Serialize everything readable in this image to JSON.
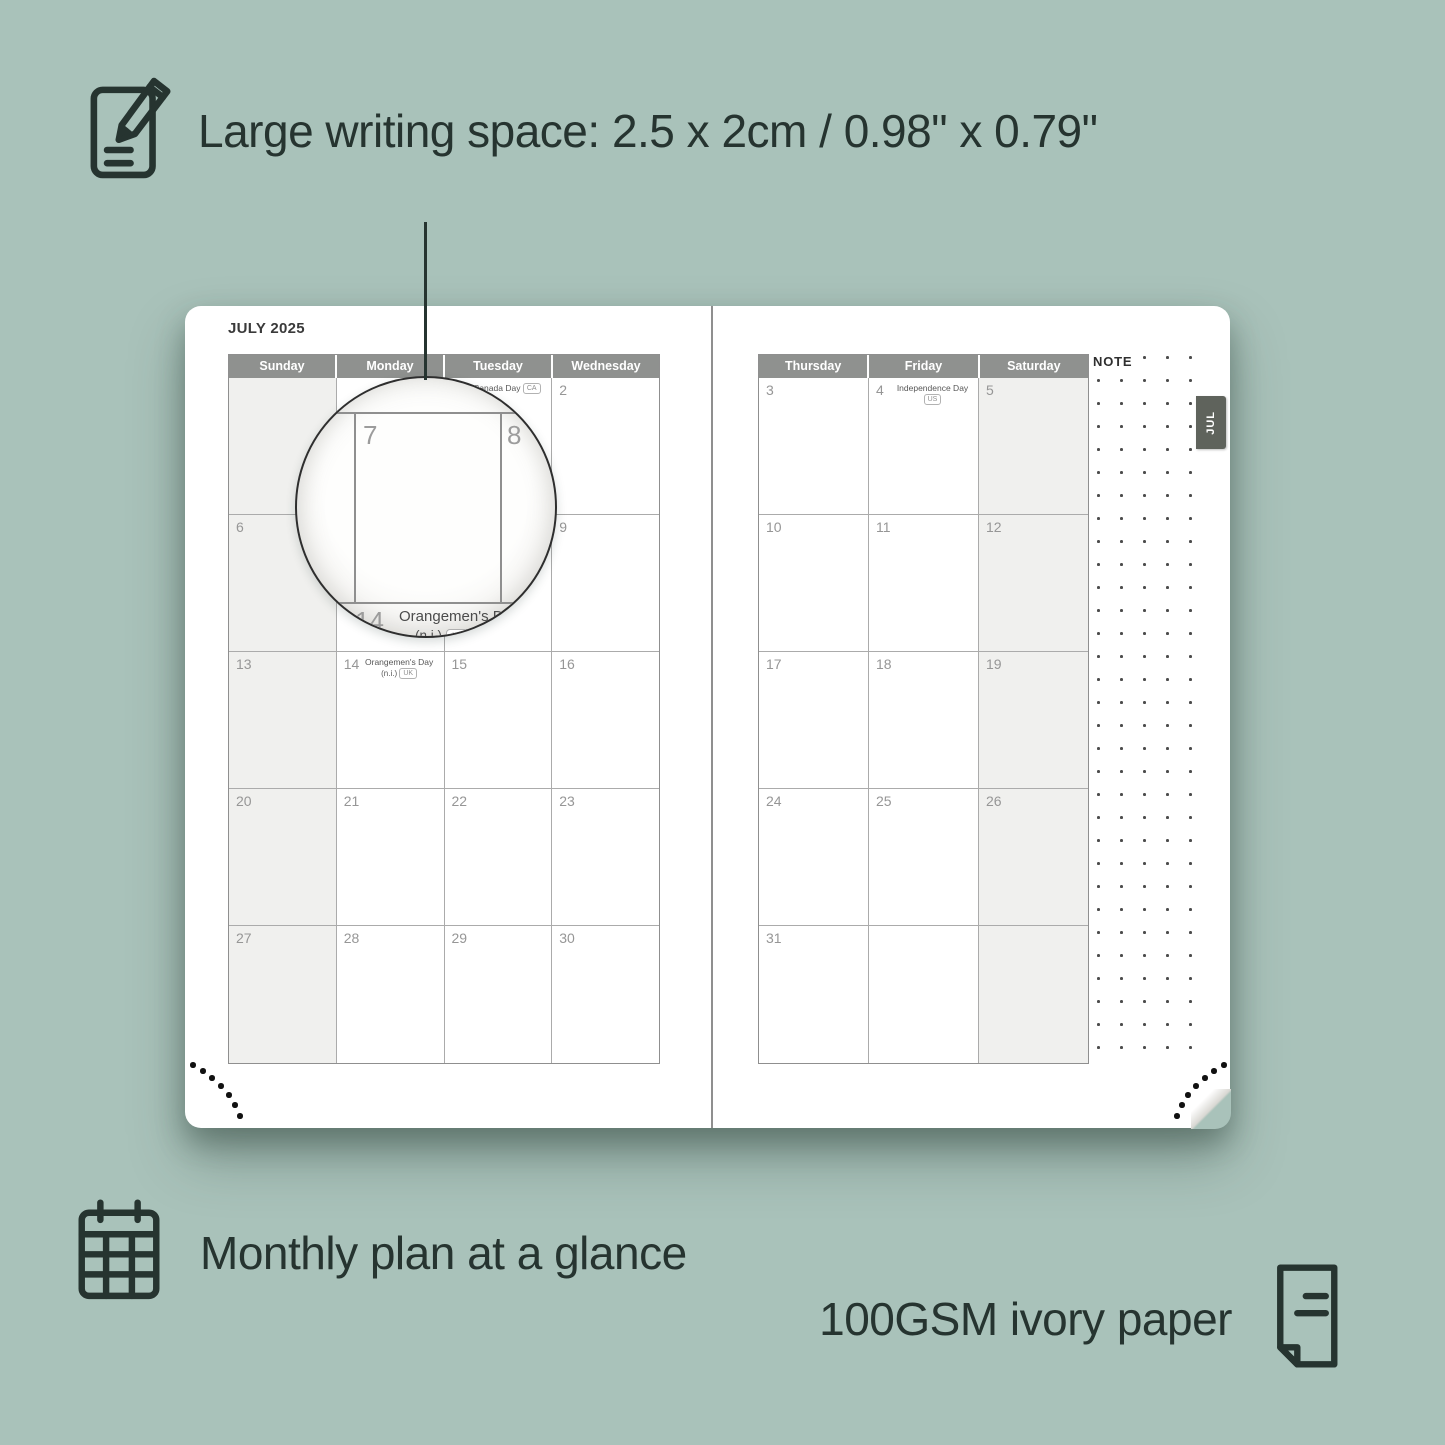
{
  "colors": {
    "background": "#a9c2ba",
    "text_dark": "#263430",
    "header_gray": "#8f918f",
    "shaded_cell": "#f0f0ee",
    "tab_bg": "#5f635c",
    "page_white": "#ffffff"
  },
  "features": {
    "top": {
      "label": "Large writing space: 2.5 x 2cm / 0.98\" x 0.79\"",
      "icon": "pencil-note-icon"
    },
    "bottom_left": {
      "label": "Monthly plan at a glance",
      "icon": "calendar-grid-icon"
    },
    "bottom_right": {
      "label": "100GSM ivory paper",
      "icon": "paper-icon"
    }
  },
  "planner": {
    "month_title": "JULY 2025",
    "tab_label": "JUL",
    "note_label": "NOTE",
    "left_day_headers": [
      "Sunday",
      "Monday",
      "Tuesday",
      "Wednesday"
    ],
    "right_day_headers": [
      "Thursday",
      "Friday",
      "Saturday"
    ],
    "left_weeks": [
      [
        {
          "day": "",
          "shaded": true
        },
        {
          "day": ""
        },
        {
          "day": "1",
          "holiday": "Canada Day",
          "tag": "CA",
          "tag_inline": true
        },
        {
          "day": "2"
        }
      ],
      [
        {
          "day": "6",
          "shaded": true
        },
        {
          "day": "7"
        },
        {
          "day": "8"
        },
        {
          "day": "9"
        }
      ],
      [
        {
          "day": "13",
          "shaded": true
        },
        {
          "day": "14",
          "holiday": "Orangemen's Day",
          "detail": "(n.i.)",
          "tag": "UK"
        },
        {
          "day": "15"
        },
        {
          "day": "16"
        }
      ],
      [
        {
          "day": "20",
          "shaded": true
        },
        {
          "day": "21"
        },
        {
          "day": "22"
        },
        {
          "day": "23"
        }
      ],
      [
        {
          "day": "27",
          "shaded": true
        },
        {
          "day": "28"
        },
        {
          "day": "29"
        },
        {
          "day": "30"
        }
      ]
    ],
    "right_weeks": [
      [
        {
          "day": "3"
        },
        {
          "day": "4",
          "holiday": "Independence Day",
          "tag": "US"
        },
        {
          "day": "5",
          "shaded": true
        }
      ],
      [
        {
          "day": "10"
        },
        {
          "day": "11"
        },
        {
          "day": "12",
          "shaded": true
        }
      ],
      [
        {
          "day": "17"
        },
        {
          "day": "18"
        },
        {
          "day": "19",
          "shaded": true
        }
      ],
      [
        {
          "day": "24"
        },
        {
          "day": "25"
        },
        {
          "day": "26",
          "shaded": true
        }
      ],
      [
        {
          "day": "31"
        },
        {
          "day": ""
        },
        {
          "day": "",
          "shaded": true
        }
      ]
    ]
  },
  "magnifier": {
    "day_left": "7",
    "day_right": "8",
    "week_day": "14",
    "holiday": "Orangemen's Day",
    "detail": "(n.i.)",
    "tag": "UK"
  }
}
